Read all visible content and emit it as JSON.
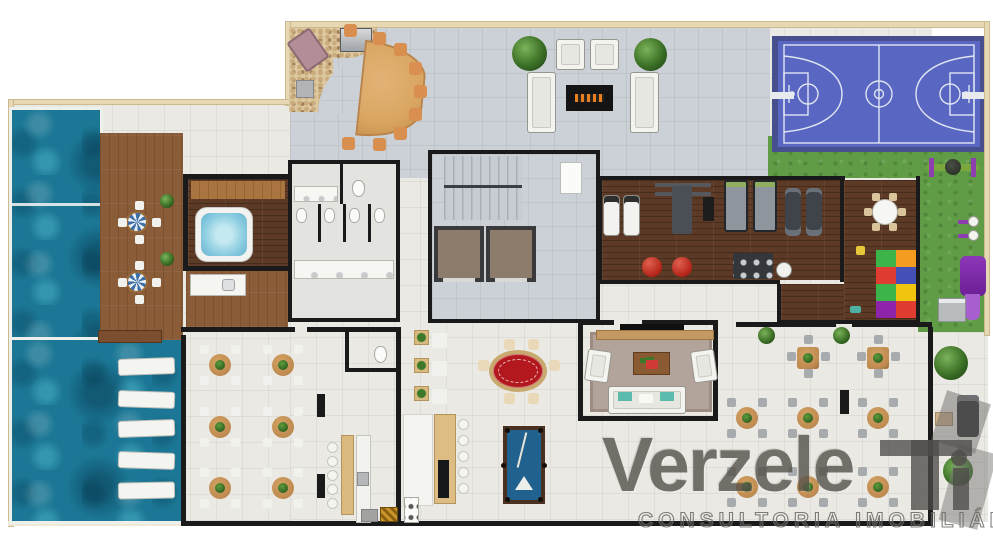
{
  "watermark": {
    "brand": "Verzele",
    "tagline": "CONSULTORIA IMOBILIÁRIA"
  },
  "palette": {
    "outer_wall": "#e7d8b4",
    "tile_light": "#ebe9e4",
    "tile_gray": "#ccd1d7",
    "wood_deck": "#8a5c38",
    "wood_dark": "#5d3a26",
    "pool": "#1b7795",
    "grass": "#5f9c45",
    "court_blue": "#5a67c2",
    "court_border": "#474f8e",
    "table_wood": "#bf8a50",
    "chair_orange": "#d98f4f",
    "poker_red": "#b3181f",
    "billiard_blue": "#20618e",
    "foam_green": "#3cb44a",
    "foam_orange": "#f39c1f",
    "foam_red": "#e03c31",
    "foam_blue": "#4450b5",
    "foam_purple": "#8e24aa",
    "foam_yellow": "#f1c40f",
    "watermark_gray": "#55514b"
  }
}
